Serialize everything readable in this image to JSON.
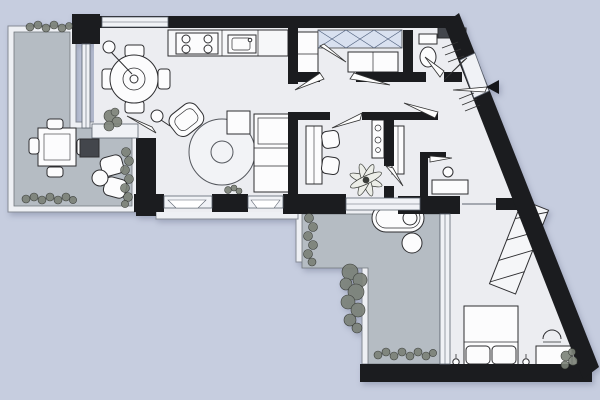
{
  "meta": {
    "type": "architectural-floor-plan",
    "description": "Top-down apartment floor plan with angled right facade, two gray terraces, open living-dining-kitchen, study, bathroom, inner hall and bedroom",
    "text_labels": []
  },
  "colors": {
    "background": "#c6cddf",
    "wall": "#1b1c1f",
    "floor": "#ecedf1",
    "terrace": "#b5bcc3",
    "frame": "#eef0f4",
    "glazing": "#f0f2f6",
    "glazing_stroke": "#5d6470",
    "furniture_fill": "#fcfcfd",
    "furniture_stroke": "#2e2e31",
    "wardrobe_fill": "#d9e1f0",
    "wardrobe_line": "#51617e",
    "rug_fill": "#f2f3f6",
    "plant_fill": "#7b8177",
    "plant_stroke": "#2c2f2a",
    "dark_item": "#43464c",
    "arrow": "#15161a"
  },
  "entry": {
    "marker": "entrance-arrow",
    "direction": "left",
    "location": "angled-east-wall"
  },
  "rooms": [
    {
      "id": "terrace-left",
      "type": "terrace",
      "furniture": [
        "outdoor-dining-table",
        "outdoor-chairs",
        "lounge-chair",
        "lounge-chair",
        "round-side-table",
        "grill-table",
        "planter-row",
        "planter-column",
        "top-planter-box"
      ]
    },
    {
      "id": "living-dining",
      "type": "living-room",
      "furniture": [
        "round-dining-table",
        "four-dining-chairs",
        "pendant-lamp",
        "armchair",
        "floor-lamp",
        "round-rug",
        "plant-side-table",
        "media-sideboard",
        "indoor-plant"
      ]
    },
    {
      "id": "kitchen",
      "type": "kitchen",
      "furniture": [
        "counter",
        "cooktop-4-burner",
        "sink",
        "tall-cabinet"
      ]
    },
    {
      "id": "entry-dressing",
      "type": "hallway",
      "furniture": [
        "built-in-wardrobe-x3",
        "low-cabinet"
      ]
    },
    {
      "id": "bathroom-wc",
      "type": "bathroom",
      "furniture": [
        "toilet",
        "cistern",
        "boiler",
        "wall-fixture",
        "towel-radiator"
      ]
    },
    {
      "id": "corridor",
      "type": "hallway",
      "furniture": []
    },
    {
      "id": "study",
      "type": "home-office",
      "furniture": [
        "desk",
        "desk-chair",
        "desk-chair",
        "slim-shelf",
        "palm-plant"
      ]
    },
    {
      "id": "inner-hall",
      "type": "hallway",
      "furniture": [
        "slim-cabinet",
        "vanity-table",
        "stool"
      ]
    },
    {
      "id": "bedroom",
      "type": "bedroom",
      "furniture": [
        "double-bed",
        "pillow",
        "pillow",
        "wall-sconce",
        "wall-sconce",
        "sliding-wardrobe",
        "dresser",
        "chair",
        "corner-plant"
      ]
    },
    {
      "id": "terrace-south",
      "type": "terrace",
      "furniture": [
        "outdoor-sofa",
        "pouf",
        "planter-column",
        "plant-cluster",
        "planter-row"
      ]
    }
  ]
}
